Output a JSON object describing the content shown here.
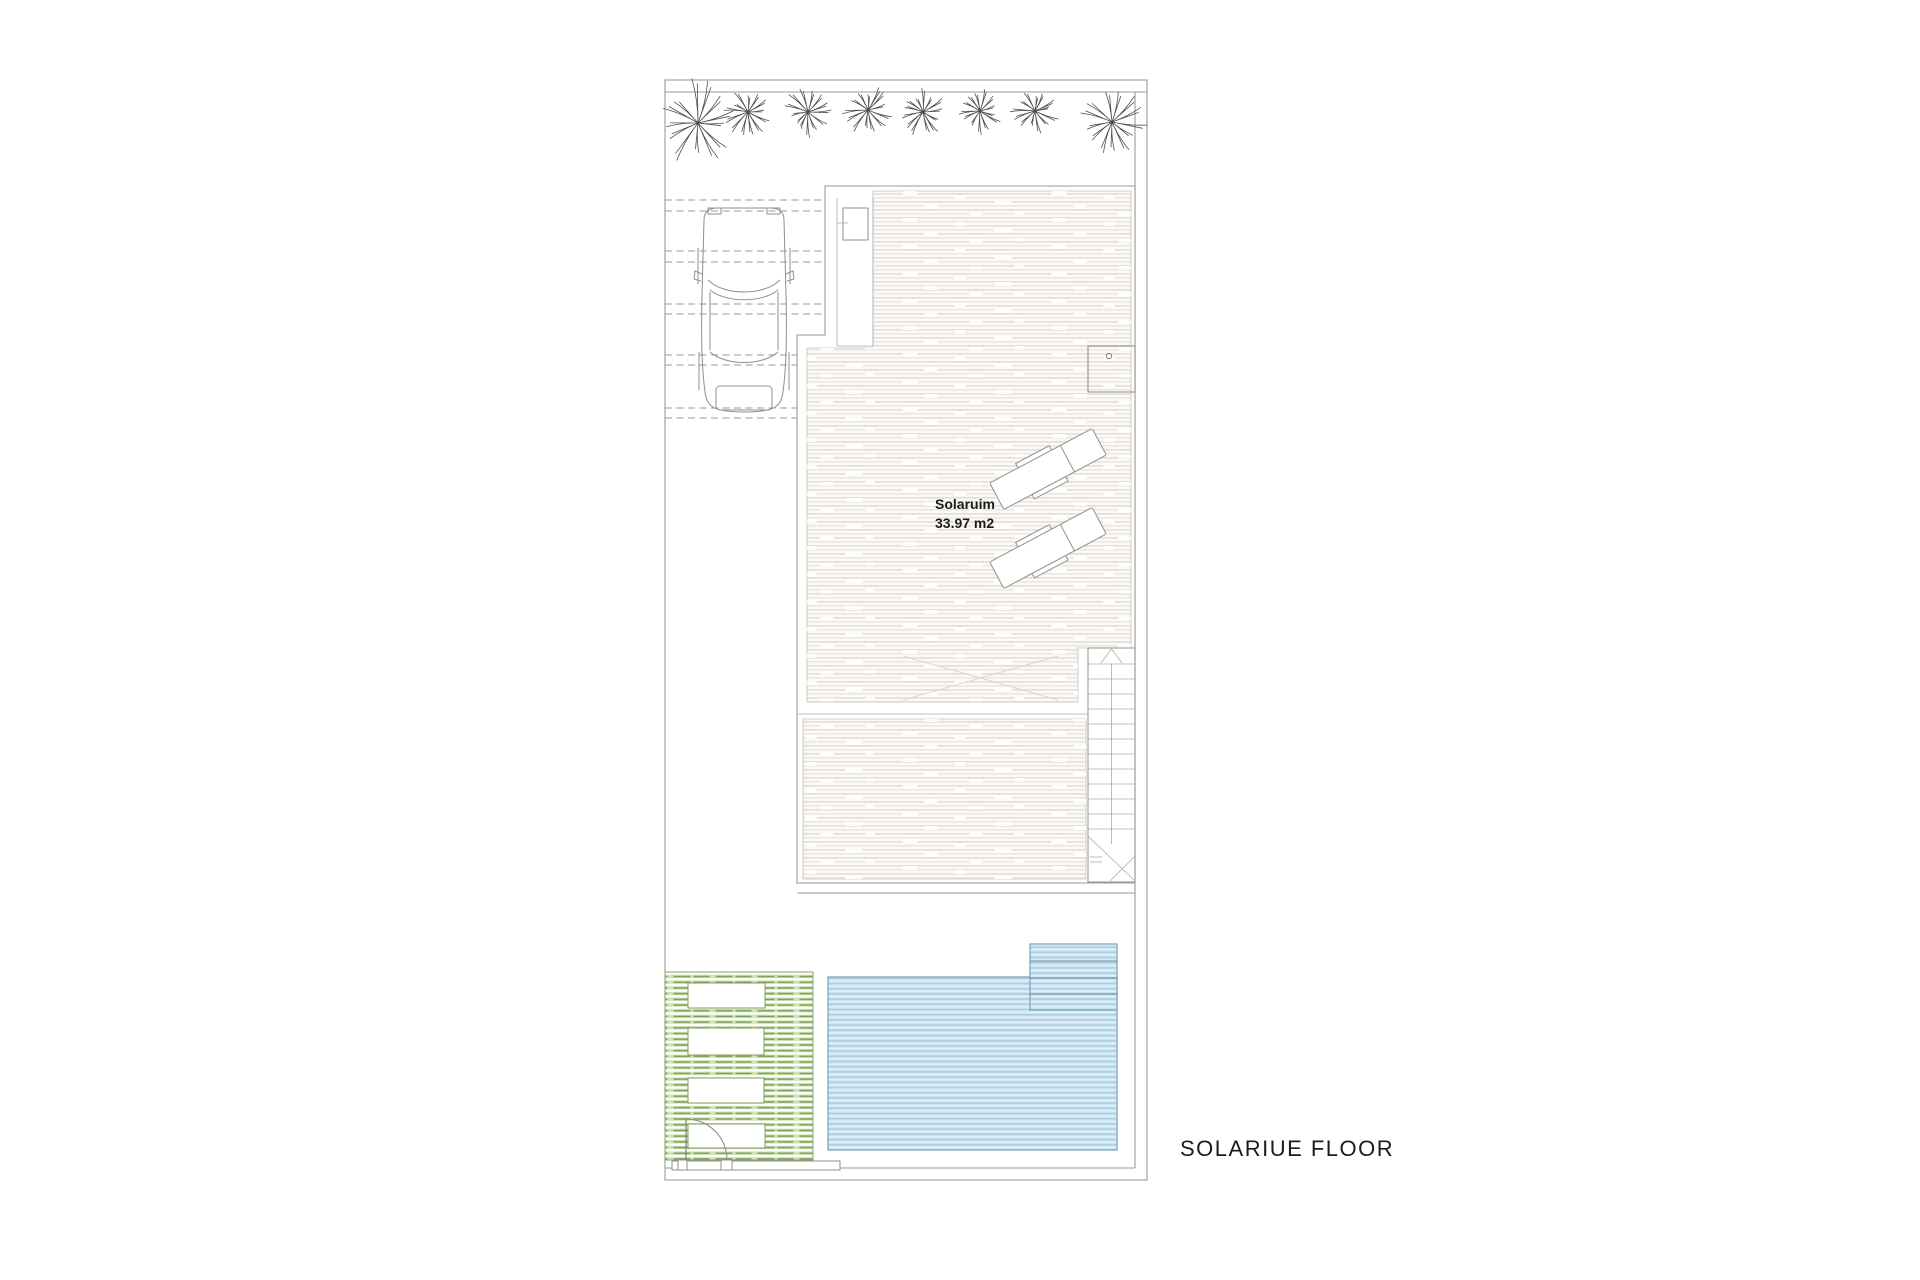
{
  "page": {
    "background": "#ffffff",
    "type": "architectural floor plan drawing"
  },
  "plan": {
    "floor_label": "SOLARIUE FLOOR",
    "room_label": {
      "name": "Solaruim",
      "area": "33.97 m2"
    },
    "features": {
      "trees": {
        "count": 8,
        "symbol": "palm-star"
      },
      "parking": {
        "bay_line_pairs": 5,
        "cars": 1
      },
      "stairs": {
        "treads": 12,
        "direction": "up"
      },
      "loungers": {
        "count": 2
      },
      "pool": {
        "steps": 4
      },
      "pergola": {
        "openings": 4
      },
      "jacuzzi": {
        "count": 1
      }
    },
    "colors": {
      "line_gray": "#9a9a9a",
      "text": "#1c1c1c",
      "wood_base": "#fbfaf7",
      "wood_stripe": "#e7e0d8",
      "wood_stripe2": "#ece7e0",
      "knot_white": "#ffffff",
      "pool_base": "#cde4f1",
      "pool_stripe": "#a9cee3",
      "pool_light": "#e9f4fb",
      "pool_border": "#7fa7bd",
      "pool_step_line": "#5d87a0",
      "green_base": "#cfe3b6",
      "green_dash": "#7aa157",
      "green_border": "#86a968"
    }
  }
}
